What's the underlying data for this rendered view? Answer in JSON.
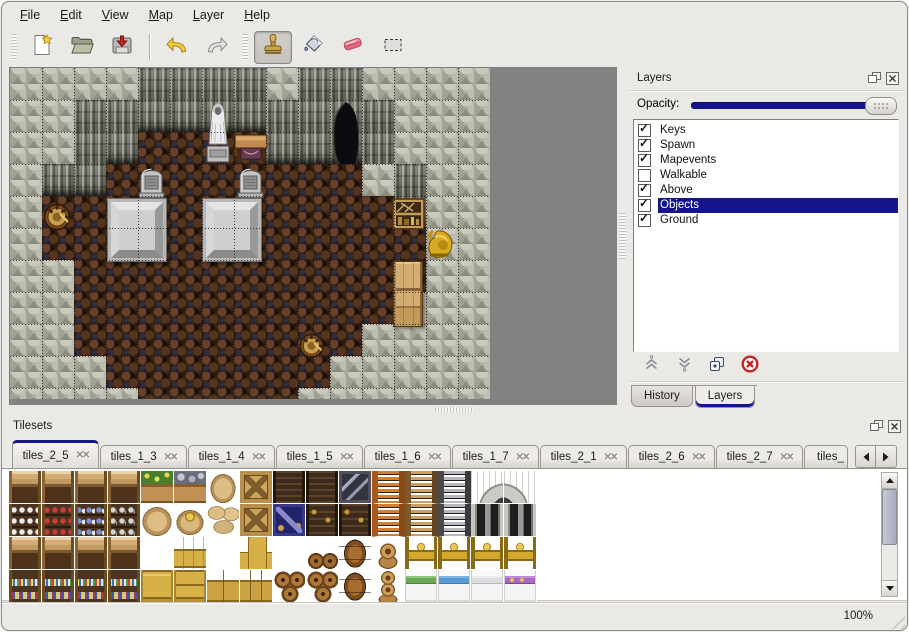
{
  "window": {
    "accent_color": "#14148c",
    "background_color": "#ebe9e6"
  },
  "menu": {
    "items": [
      "File",
      "Edit",
      "View",
      "Map",
      "Layer",
      "Help"
    ]
  },
  "toolbar": {
    "groups": [
      {
        "lead": "grip",
        "buttons": [
          {
            "name": "new",
            "icon": "new-file-icon"
          },
          {
            "name": "open",
            "icon": "open-folder-icon"
          },
          {
            "name": "save",
            "icon": "save-icon"
          }
        ]
      },
      {
        "lead": "sep",
        "buttons": [
          {
            "name": "undo",
            "icon": "undo-icon"
          },
          {
            "name": "redo",
            "icon": "redo-icon"
          }
        ]
      },
      {
        "lead": "grip",
        "buttons": [
          {
            "name": "stamp",
            "icon": "stamp-tool-icon",
            "selected": true
          },
          {
            "name": "fill",
            "icon": "fill-tool-icon"
          },
          {
            "name": "eraser",
            "icon": "eraser-tool-icon"
          },
          {
            "name": "select",
            "icon": "select-tool-icon"
          }
        ]
      }
    ]
  },
  "layers_panel": {
    "title": "Layers",
    "opacity_label": "Opacity:",
    "opacity_value": 100,
    "layers": [
      {
        "name": "Keys",
        "checked": true,
        "selected": false
      },
      {
        "name": "Spawn",
        "checked": true,
        "selected": false
      },
      {
        "name": "Mapevents",
        "checked": true,
        "selected": false
      },
      {
        "name": "Walkable",
        "checked": false,
        "selected": false
      },
      {
        "name": "Above",
        "checked": true,
        "selected": false
      },
      {
        "name": "Objects",
        "checked": true,
        "selected": true
      },
      {
        "name": "Ground",
        "checked": true,
        "selected": false
      }
    ],
    "buttons": [
      {
        "name": "raise-layer"
      },
      {
        "name": "lower-layer"
      },
      {
        "name": "duplicate-layer"
      },
      {
        "name": "delete-layer"
      }
    ],
    "tabs": [
      {
        "label": "History",
        "active": false
      },
      {
        "label": "Layers",
        "active": true
      }
    ]
  },
  "tilesets_panel": {
    "title": "Tilesets",
    "tabs": [
      {
        "label": "tiles_2_5",
        "active": true
      },
      {
        "label": "tiles_1_3",
        "active": false
      },
      {
        "label": "tiles_1_4",
        "active": false
      },
      {
        "label": "tiles_1_5",
        "active": false
      },
      {
        "label": "tiles_1_6",
        "active": false
      },
      {
        "label": "tiles_1_7",
        "active": false
      },
      {
        "label": "tiles_2_1",
        "active": false
      },
      {
        "label": "tiles_2_6",
        "active": false
      },
      {
        "label": "tiles_2_7",
        "active": false
      },
      {
        "label": "tiles_",
        "active": false,
        "partial": true
      }
    ]
  },
  "statusbar": {
    "zoom_level": "100%"
  },
  "map": {
    "tile_size": 32,
    "cols": 15,
    "legend": {
      "R": "rock-wall",
      "C": "cliff-face",
      "F": "dirt-floor"
    },
    "grid": [
      "RRRRCCCCRCCRRRR",
      "RRCCCCCCCCCCRRR",
      "RRCCFFFFCCCCRRR",
      "RCCFFFFFFFFRCRR",
      "RFFFFFFFFFFFCRR",
      "RFFFFFFFFFFFFRR",
      "RRFFFFFFFFFFFRR",
      "RRFFFFFFFFFFRRR",
      "RRFFFFFFFFFRRRR",
      "RRRFFFFFFFRRRRR",
      "RRRRFFFFFRRRRRR"
    ],
    "objects": [
      {
        "type": "entrance",
        "x": 318,
        "y": 33,
        "w": 34,
        "h": 64
      },
      {
        "type": "slab",
        "x": 97,
        "y": 130,
        "w": 60,
        "h": 64
      },
      {
        "type": "slab",
        "x": 192,
        "y": 130,
        "w": 60,
        "h": 64
      },
      {
        "type": "gravestone",
        "x": 128,
        "y": 97,
        "w": 27,
        "h": 33
      },
      {
        "type": "gravestone",
        "x": 227,
        "y": 97,
        "w": 27,
        "h": 33
      },
      {
        "type": "statue",
        "x": 192,
        "y": 34,
        "w": 32,
        "h": 62
      },
      {
        "type": "table",
        "x": 224,
        "y": 66,
        "w": 34,
        "h": 32
      },
      {
        "type": "bucket",
        "x": 32,
        "y": 133,
        "w": 31,
        "h": 30
      },
      {
        "type": "shelf",
        "x": 382,
        "y": 130,
        "w": 33,
        "h": 32
      },
      {
        "type": "idol",
        "x": 415,
        "y": 160,
        "w": 30,
        "h": 32
      },
      {
        "type": "cabinet",
        "x": 383,
        "y": 193,
        "w": 30,
        "h": 66
      },
      {
        "type": "bucket",
        "x": 288,
        "y": 261,
        "w": 28,
        "h": 32
      }
    ]
  },
  "tileset_grid": {
    "cols": 16,
    "tile_size": 33,
    "rows": [
      [
        "shelf_top",
        "shelf_top",
        "shelf_top",
        "shelf_top",
        "plant_crate",
        "ore_crate",
        "sack",
        "crate_x",
        "dark_shelf",
        "dark_shelf",
        "metal_crate",
        "ladder_o",
        "ladder_b",
        "ladder_g",
        "arch_l",
        "arch_r"
      ],
      [
        "shelf_dish",
        "shelf_red",
        "shelf_blue",
        "shelf_jar",
        "sack_big",
        "sack_open",
        "sack_pile",
        "crate_x",
        "crate_blue",
        "dark_shelf2",
        "dark_shelf2",
        "ladder_o",
        "ladder_b",
        "ladder_g",
        "door_l",
        "door_r"
      ],
      [
        "shelf_top",
        "shelf_top",
        "shelf_top",
        "shelf_top",
        "empty",
        "crate_top",
        "empty",
        "crate_sm",
        "empty",
        "barrel_pair",
        "barrel",
        "pot",
        "bed_head",
        "bed_head",
        "bed_head",
        "bed_head"
      ],
      [
        "shelf_bot",
        "shelf_bot",
        "shelf_bot",
        "shelf_bot",
        "crate_y",
        "crate_y2",
        "crate_pair",
        "crate_tri",
        "barrel_stack",
        "barrel_stack",
        "barrel",
        "pots",
        "bed_g",
        "bed_b",
        "bed_w",
        "bed_p"
      ]
    ]
  }
}
